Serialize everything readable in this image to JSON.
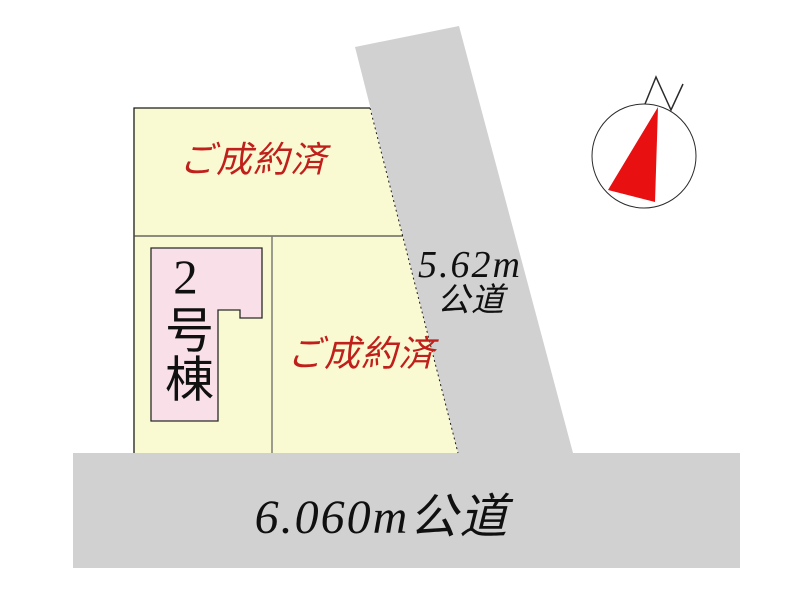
{
  "canvas": {
    "width": 800,
    "height": 599,
    "background": "#ffffff"
  },
  "colors": {
    "plot_fill": "#fafad2",
    "road_fill": "#d1d1d1",
    "building_fill": "#f9e0e8",
    "status_red": "#c0201c",
    "compass_needle_red": "#e81010",
    "line_dark": "#1c1c1c"
  },
  "plots": {
    "top": {
      "status": "ご成約済"
    },
    "bottom_left": {
      "building_label": "2号棟"
    },
    "bottom_right": {
      "status": "ご成約済"
    }
  },
  "roads": {
    "side": {
      "width_label": "5.62m",
      "type_label": "公道"
    },
    "front": {
      "label": "6.060m公道"
    }
  },
  "compass": {
    "label": "N"
  }
}
